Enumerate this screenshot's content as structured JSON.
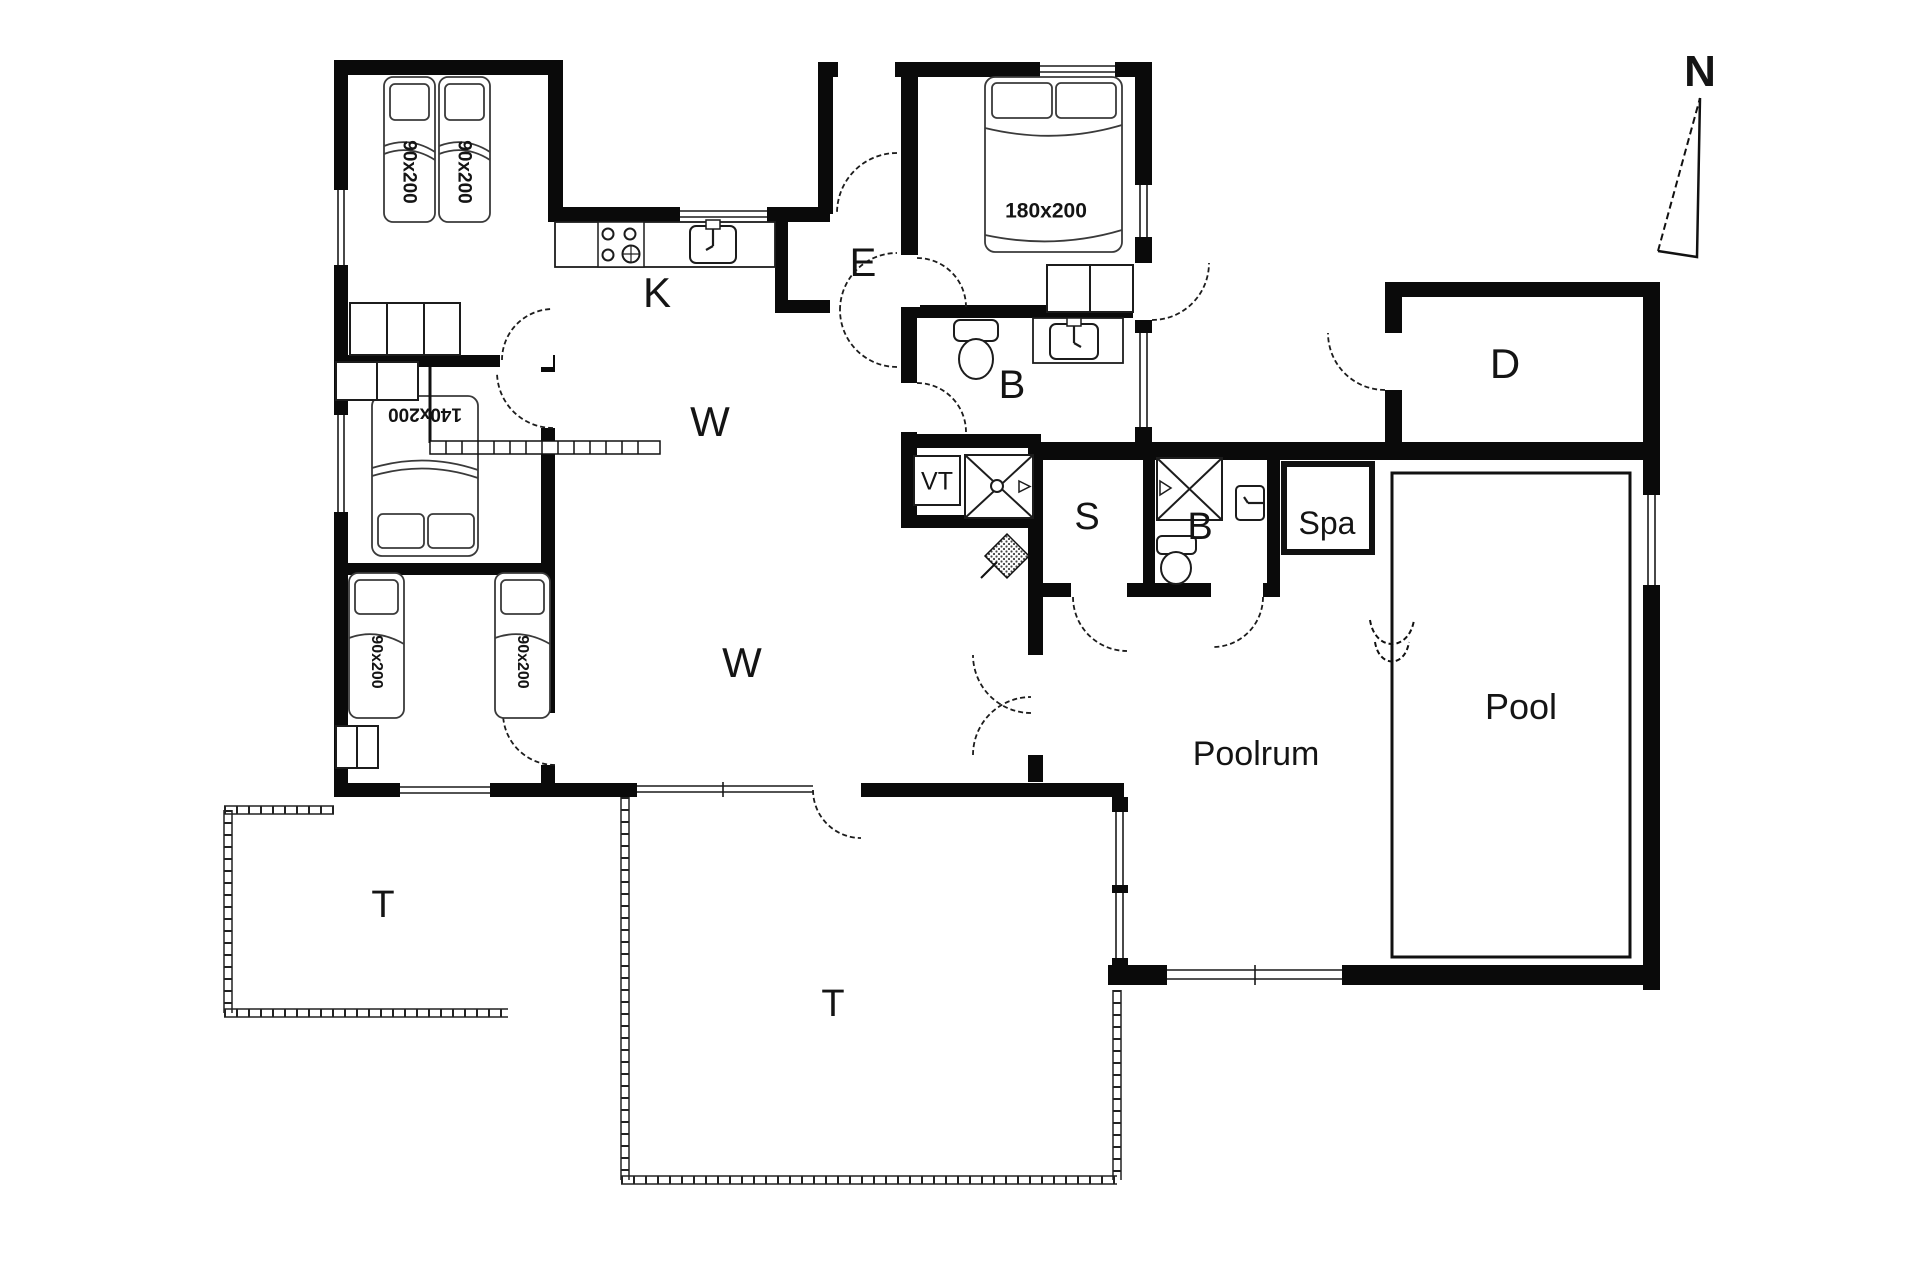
{
  "title": "Summerhouse floor plan",
  "colors": {
    "ink": "#141414",
    "wall": "#0a0a0a",
    "background": "#ffffff",
    "fixture": "#2a2a2a"
  },
  "compass": {
    "label": "N"
  },
  "room_labels": [
    {
      "id": "kitchen",
      "label": "K",
      "x": 657,
      "y": 293,
      "size": 42,
      "weight": 400
    },
    {
      "id": "living-upper",
      "label": "W",
      "x": 710,
      "y": 422,
      "size": 42,
      "weight": 400
    },
    {
      "id": "living-lower",
      "label": "W",
      "x": 742,
      "y": 663,
      "size": 42,
      "weight": 400
    },
    {
      "id": "entry",
      "label": "E",
      "x": 863,
      "y": 263,
      "size": 40,
      "weight": 400
    },
    {
      "id": "bath-1",
      "label": "B",
      "x": 1012,
      "y": 385,
      "size": 40,
      "weight": 400
    },
    {
      "id": "sauna",
      "label": "S",
      "x": 1087,
      "y": 517,
      "size": 38,
      "weight": 400
    },
    {
      "id": "bath-2",
      "label": "B",
      "x": 1200,
      "y": 527,
      "size": 38,
      "weight": 400
    },
    {
      "id": "depot",
      "label": "D",
      "x": 1505,
      "y": 364,
      "size": 42,
      "weight": 400
    },
    {
      "id": "spa",
      "label": "Spa",
      "x": 1327,
      "y": 523,
      "size": 32,
      "weight": 400
    },
    {
      "id": "pool",
      "label": "Pool",
      "x": 1521,
      "y": 707,
      "size": 36,
      "weight": 400
    },
    {
      "id": "poolroom",
      "label": "Poolrum",
      "x": 1256,
      "y": 754,
      "size": 34,
      "weight": 400
    },
    {
      "id": "utility",
      "label": "VT",
      "x": 937,
      "y": 482,
      "size": 25,
      "weight": 400
    },
    {
      "id": "terrace-west",
      "label": "T",
      "x": 383,
      "y": 905,
      "size": 38,
      "weight": 400
    },
    {
      "id": "terrace-south",
      "label": "T",
      "x": 833,
      "y": 1004,
      "size": 38,
      "weight": 400
    },
    {
      "id": "compass-n",
      "label": "N",
      "x": 1700,
      "y": 72,
      "size": 44,
      "weight": 600
    }
  ],
  "bed_labels": [
    {
      "id": "bed-90-a",
      "label": "90x200",
      "x": 409,
      "y": 172,
      "rot": 90,
      "size": 19
    },
    {
      "id": "bed-90-b",
      "label": "90x200",
      "x": 464,
      "y": 172,
      "rot": 90,
      "size": 19
    },
    {
      "id": "bed-140",
      "label": "140x200",
      "x": 425,
      "y": 414,
      "rot": 180,
      "size": 19
    },
    {
      "id": "bed-90-c",
      "label": "90x200",
      "x": 376,
      "y": 662,
      "rot": 90,
      "size": 16
    },
    {
      "id": "bed-90-d",
      "label": "90x200",
      "x": 522,
      "y": 662,
      "rot": 90,
      "size": 16
    },
    {
      "id": "bed-180",
      "label": "180x200",
      "x": 1046,
      "y": 211,
      "rot": 0,
      "size": 21
    }
  ]
}
